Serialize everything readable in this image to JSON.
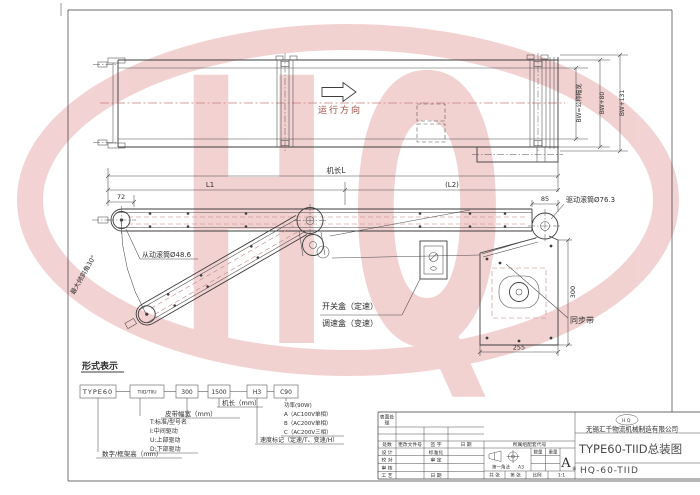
{
  "watermark": {
    "text": "HQ",
    "color": "#f0caca"
  },
  "colors": {
    "line": "#3d3d3d",
    "centerline_red": "#c87f7f",
    "watermark_pink": "#f0caca",
    "direction_text": "#9a4a42"
  },
  "plan_view": {
    "direction_label": "运行方向",
    "dim_belt_width": "BW=公称幅宽",
    "dim_frame_width": "BW+80",
    "dim_overall_width": "BW+131"
  },
  "length_dims": {
    "machine_length": "机长L",
    "l1": "L1",
    "l2": "(L2)",
    "left_offset": "72"
  },
  "side_view": {
    "driven_roller": "从动滚筒Ø48.6",
    "max_angle": "最大倾斜角30°",
    "switch_box": "开关盒（定速）",
    "speed_box": "调速盒（变速）",
    "drive_roller": "驱动滚筒Ø76.3",
    "timing_belt": "同步带",
    "dim_85": "85",
    "dim_300": "300",
    "dim_255": "255"
  },
  "designation": {
    "heading": "形式表示",
    "boxes": [
      "TYPE60",
      "TIID/TIIU",
      "300",
      "1500",
      "H3",
      "C90"
    ],
    "frame_height_label": "数字/框架高（mm）",
    "drive_type_labels": [
      "T:标准/型号名",
      "I:中间驱动",
      "U:上部驱动",
      "D:下部驱动"
    ],
    "belt_width_label": "皮带幅宽（mm）",
    "machine_length_label": "机长（mm）",
    "speed_mark_label": "速度标记（定速/T、变速/H）",
    "power_labels": [
      "功率(90W)",
      "A（AC100V单相）",
      "B（AC200V单相）",
      "C（AC200V三相）"
    ]
  },
  "title_block": {
    "surface_line1": "表面处",
    "surface_line2": "理",
    "rev_headers": [
      "处数",
      "更改文件号",
      "签 字",
      "日 期"
    ],
    "role_rows": [
      {
        "l": "设 计",
        "r": "标准化"
      },
      {
        "l": "校 对",
        "r": "审 定"
      },
      {
        "l": "审 核",
        "r": ""
      },
      {
        "l": "工 艺",
        "r": "日 期"
      }
    ],
    "belong_code": "所属组配套代号",
    "projection_label": "第一角法",
    "paper": "A3",
    "qty_label": "数量",
    "weight_label": "重量",
    "grade": "A",
    "grade_sub": "级",
    "total_label": "共  张",
    "sheet_label": "第  张",
    "scale_label": "比例",
    "scale_value": "1:1",
    "logo": "HQ",
    "company": "无锡汇千物流机械制造有限公司",
    "title": "TYPE60-TIID总装图",
    "drawing_no": "HQ-60-TIID"
  }
}
